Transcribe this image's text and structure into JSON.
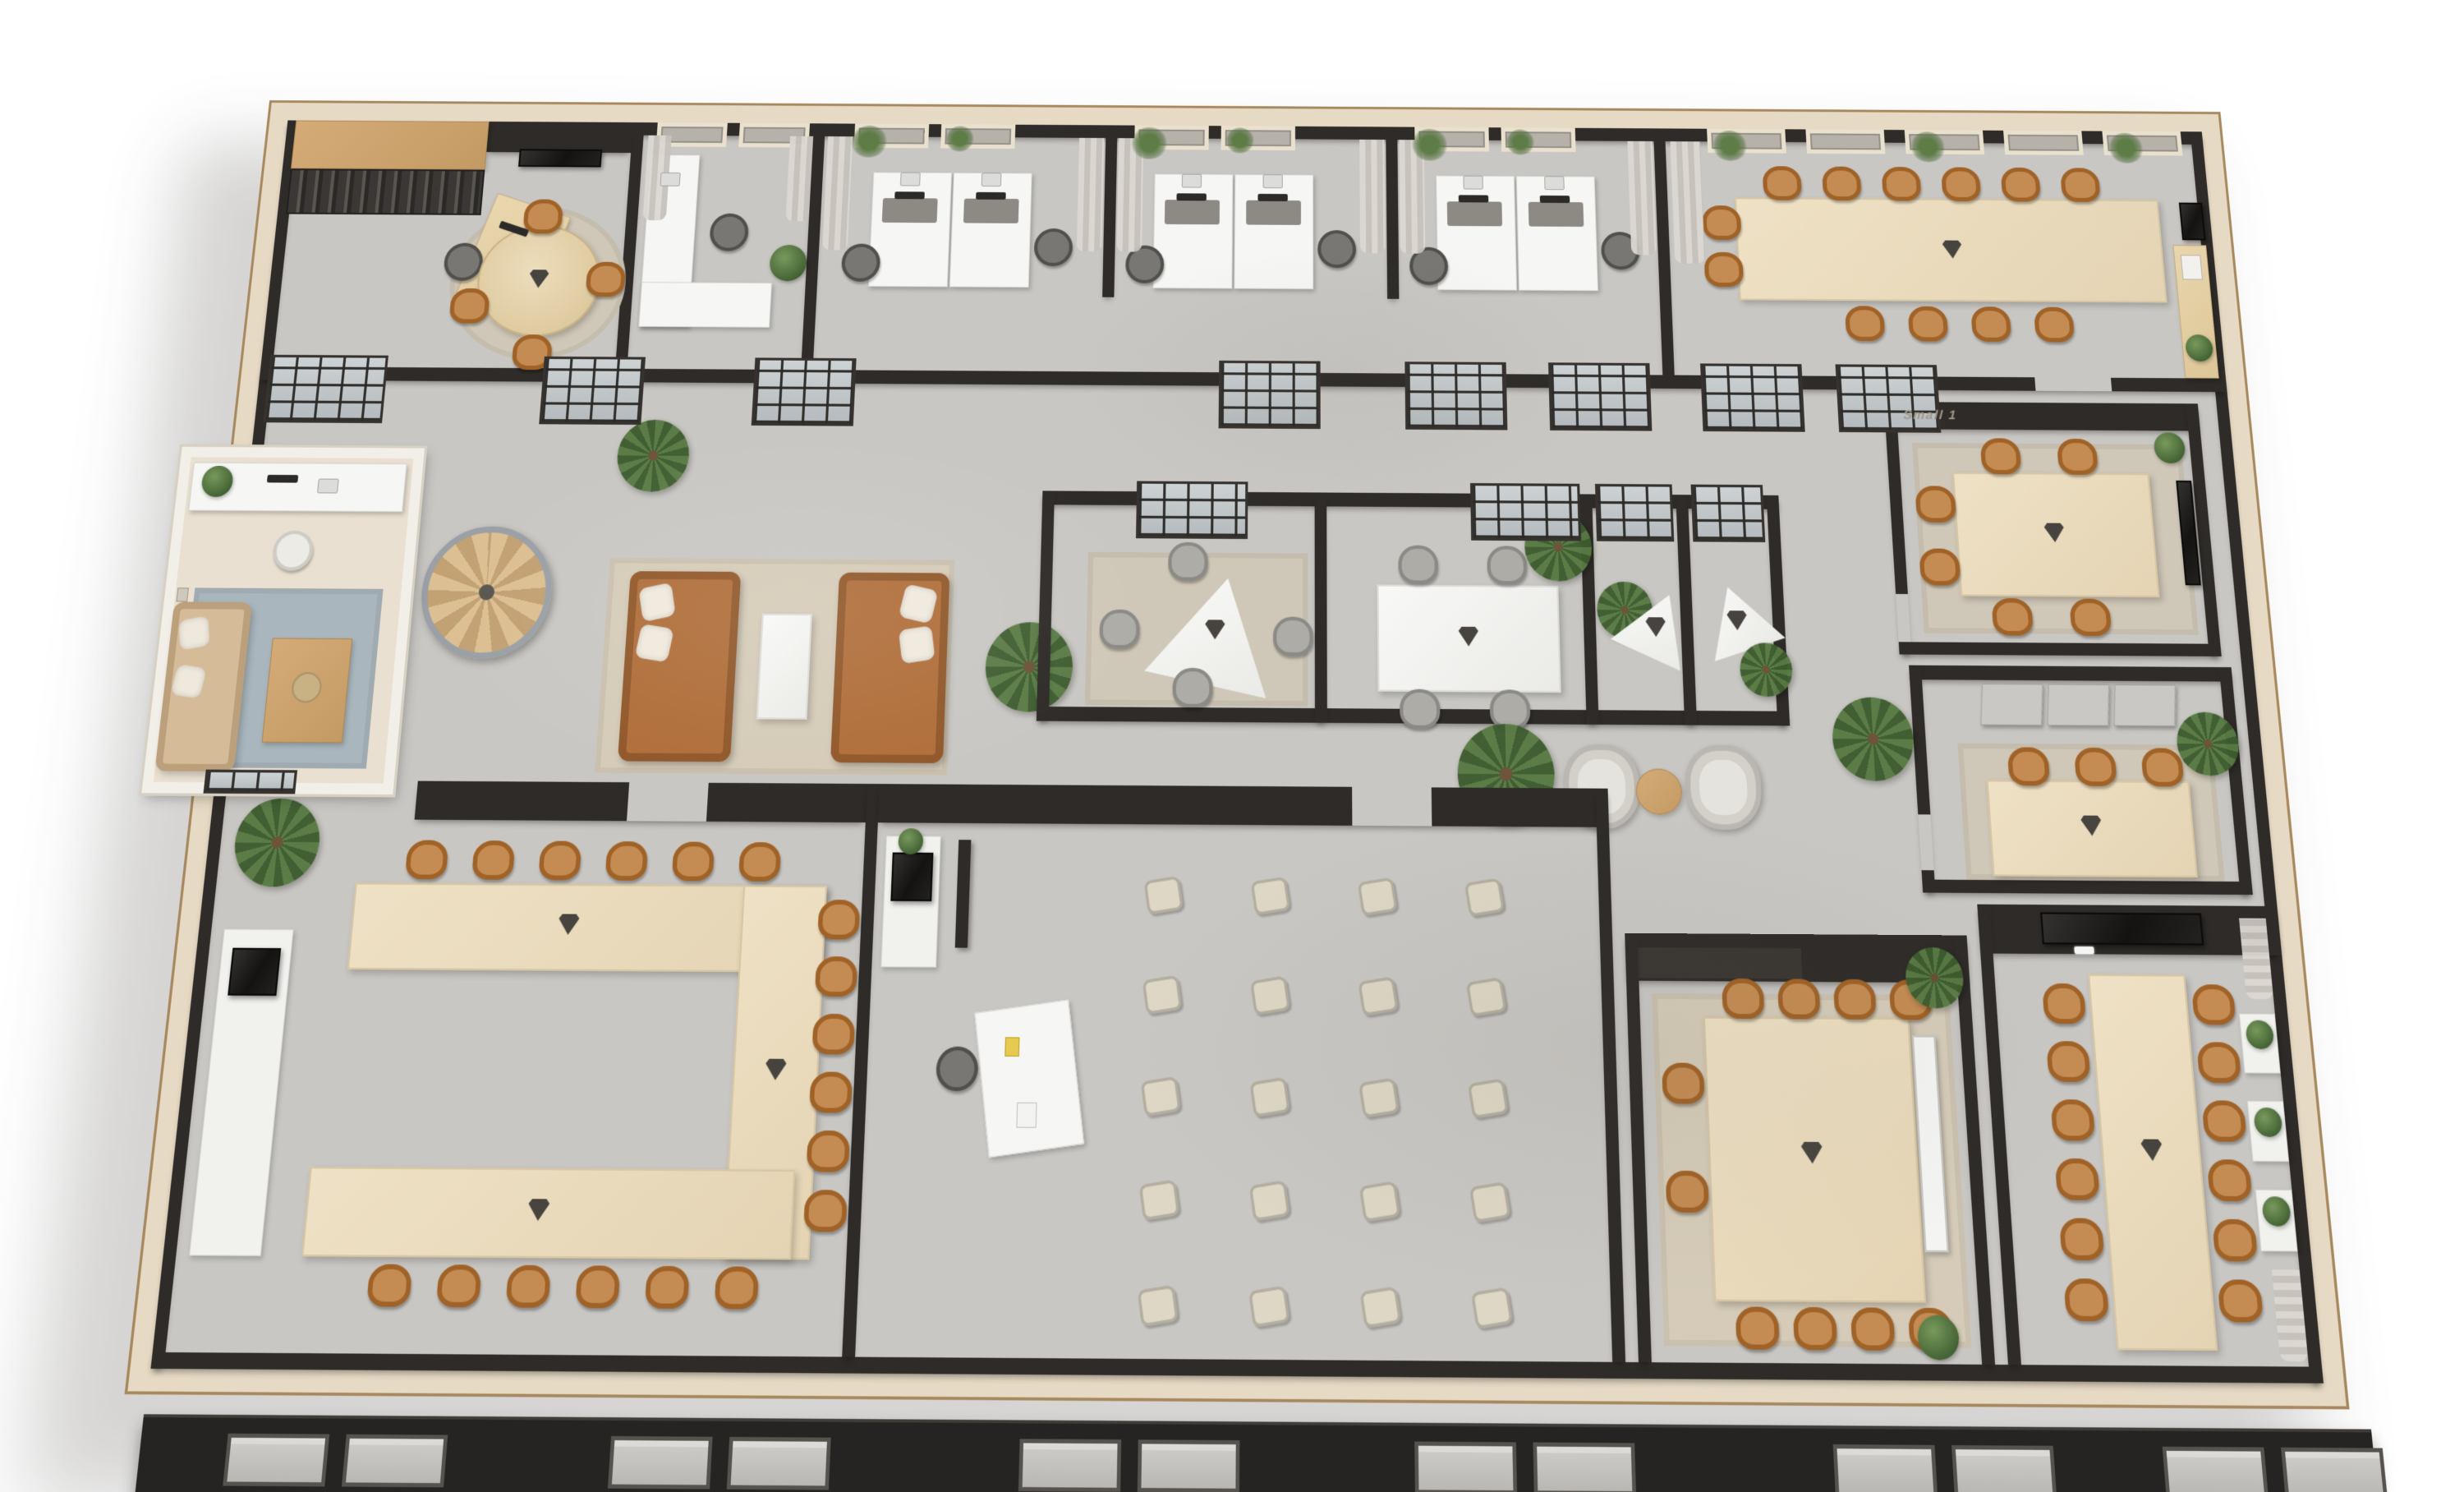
{
  "scene": {
    "description": "isometric-3d-office-floor-plan-render",
    "background_color": "#ffffff"
  },
  "signage": {
    "small_room_label": "Small 1"
  },
  "palette": {
    "exterior_wall_cap": "#e6dac4",
    "exterior_wall_trim": "#a8895f",
    "interior_wall_dark": "#2e2b28",
    "floor_concrete": "#c9c7c3",
    "annex_wood_floor": "#e9e0d1",
    "south_facade": "#262422",
    "table_wood_light": "#e9dcc0",
    "table_white": "#f3f3f0",
    "chair_leather_tan": "#b0702f",
    "chair_meeting_gray": "#9b9a96",
    "chair_training_cream": "#ded7c5",
    "sofa_leather_tan": "#b06e3a",
    "sofa_annex_beige": "#d6bb98",
    "rug_beige": "#d5cbb8",
    "rug_blue_gray": "#a9b6bd",
    "plant_green": "#4e6f3c",
    "glass_partition": "#c3c9cc",
    "signage_text": "#a1988a"
  },
  "rooms": [
    {
      "id": "reception-office",
      "leather_chairs": 4,
      "features": [
        "binder-shelving",
        "wood-cabinet",
        "reception-desk",
        "round-table",
        "wall-tv",
        "round-rug"
      ]
    },
    {
      "id": "private-office",
      "features": [
        "l-shaped-white-desk",
        "task-chair",
        "laptop",
        "plant",
        "windows-with-curtains"
      ]
    },
    {
      "id": "open-workspace",
      "desk_pods": 3,
      "desks": 6,
      "task_chairs": 6,
      "features": [
        "monitors",
        "laptops",
        "window-plants",
        "curtain-dividers"
      ]
    },
    {
      "id": "north-conference-room",
      "leather_chairs": 12,
      "features": [
        "long-wood-table",
        "speakerphone",
        "sideboard-with-magazines",
        "wall-display",
        "windows-with-curtains"
      ]
    },
    {
      "id": "studio-annex",
      "features": [
        "white-desk",
        "monitor",
        "laptop",
        "white-chair",
        "beige-sofa",
        "pillows",
        "coffee-table",
        "blue-rug",
        "framed-pictures",
        "glass-door"
      ]
    },
    {
      "id": "spiral-staircase",
      "features": [
        "wood-treads",
        "metal-railing"
      ]
    },
    {
      "id": "lounge",
      "sofas": 2,
      "features": [
        "tan-leather-sofas",
        "cream-coffee-table",
        "beige-rug"
      ]
    },
    {
      "id": "meeting-room-a",
      "gray_chairs": 4,
      "features": [
        "triangular-white-table",
        "speakerphone",
        "rug",
        "glass-front",
        "palm"
      ]
    },
    {
      "id": "meeting-room-b",
      "gray_chairs": 4,
      "features": [
        "white-table",
        "speakerphone",
        "glass-front",
        "palm"
      ]
    },
    {
      "id": "phone-booth-1",
      "features": [
        "triangular-white-table",
        "speakerphone",
        "palm",
        "glass-front"
      ]
    },
    {
      "id": "phone-booth-2",
      "features": [
        "triangular-white-table",
        "speakerphone",
        "palm",
        "glass-front"
      ]
    },
    {
      "id": "breakout-corner",
      "armchairs": 2,
      "features": [
        "round-side-table",
        "palm"
      ]
    },
    {
      "id": "small-meeting-room-1",
      "label": "Small 1",
      "leather_chairs": 6,
      "features": [
        "wood-table",
        "speakerphone",
        "rug",
        "wall-display",
        "plant"
      ]
    },
    {
      "id": "small-meeting-room-2",
      "leather_chairs": 3,
      "features": [
        "wood-table",
        "speakerphone",
        "acoustic-wall-panels",
        "palm",
        "rug"
      ]
    },
    {
      "id": "boardroom-u-table",
      "leather_chairs": 18,
      "speakerphones": 3,
      "features": [
        "u-shaped-wood-table",
        "white-credenza",
        "coffee-machine",
        "palm"
      ]
    },
    {
      "id": "training-room",
      "training_chairs": 20,
      "chair_grid": "4x5",
      "features": [
        "presenter-white-desk",
        "task-chair",
        "white-cabinet",
        "coffee-machine",
        "dark-flipchart-board"
      ]
    },
    {
      "id": "south-meeting-room",
      "leather_chairs": 10,
      "features": [
        "square-wood-table",
        "speakerphone",
        "rug",
        "leaning-whiteboard",
        "dark-sideboard",
        "plants"
      ]
    },
    {
      "id": "long-table-room",
      "leather_chairs": 12,
      "features": [
        "long-wood-table",
        "speakerphone",
        "wall-tv",
        "clock-display",
        "wall-shelves-with-plants",
        "curtains"
      ]
    }
  ]
}
